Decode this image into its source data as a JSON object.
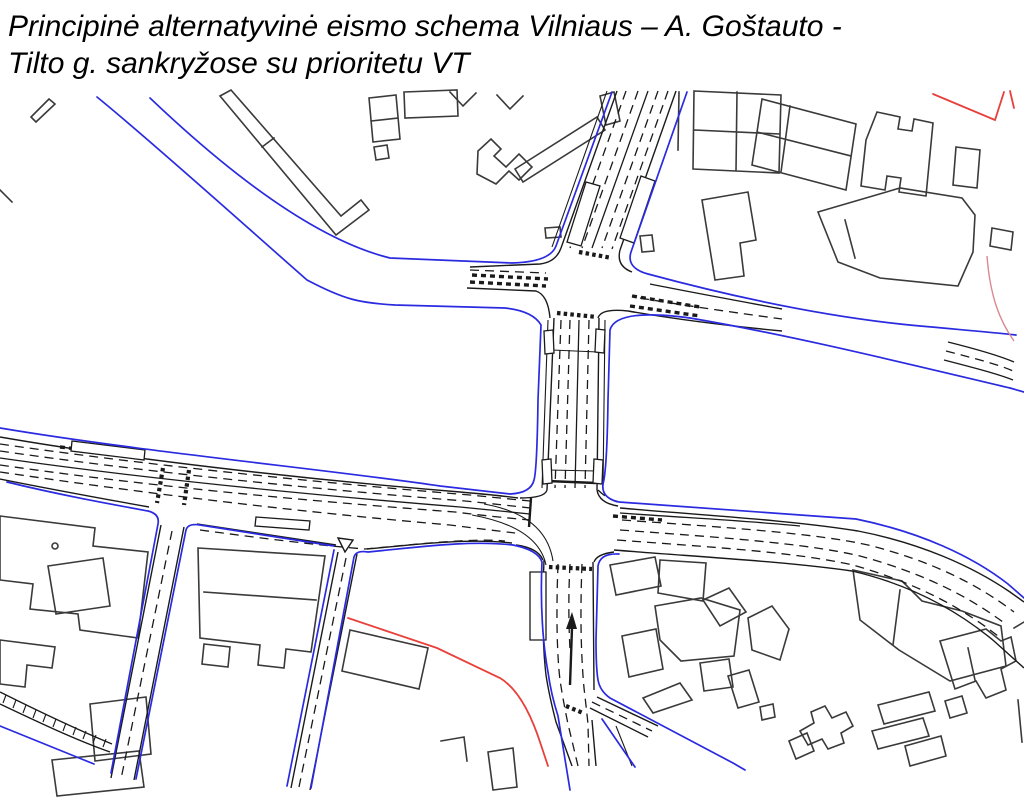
{
  "title": {
    "line1": "Principinė alternatyvinė eismo schema Vilniaus – A. Goštauto -",
    "line2": "Tilto g. sankryžose su prioritetu VT"
  },
  "map": {
    "kind": "cad-traffic-scheme-plan",
    "colors": {
      "background": "#ffffff",
      "building": "#3a3a3a",
      "road_edge": "#1a1a1a",
      "lane_marking": "#1a1a1a",
      "boundary_blue": "#2a2ae0",
      "boundary_red": "#e8403a",
      "boundary_pink": "#d9898f"
    }
  }
}
